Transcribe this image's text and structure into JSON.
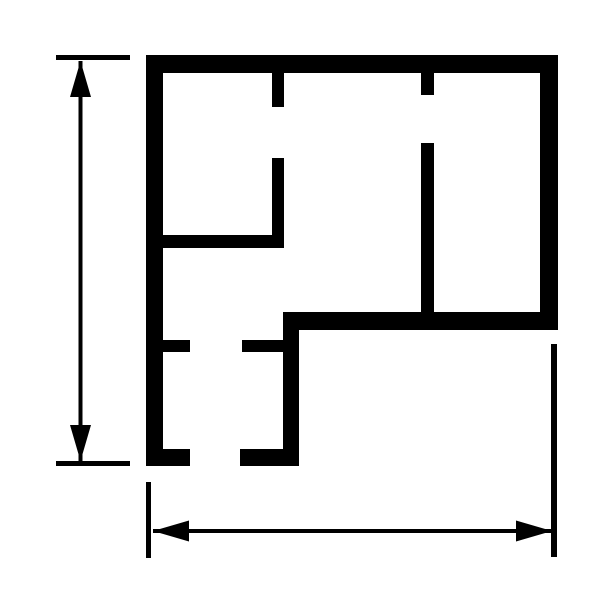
{
  "canvas": {
    "width": 612,
    "height": 612,
    "background_color": "#ffffff",
    "ink_color": "#000000"
  },
  "floorplan": {
    "description": "floor-plan-outline-with-dimension-lines",
    "walls": [
      {
        "name": "outer-top-wall",
        "x": 146,
        "y": 55,
        "w": 412,
        "h": 18
      },
      {
        "name": "outer-left-wall",
        "x": 146,
        "y": 55,
        "w": 17,
        "h": 411
      },
      {
        "name": "outer-right-wall",
        "x": 540,
        "y": 55,
        "w": 18,
        "h": 275
      },
      {
        "name": "outer-bottom-right-wall",
        "x": 283,
        "y": 312,
        "w": 275,
        "h": 18
      },
      {
        "name": "outer-step-wall",
        "x": 283,
        "y": 312,
        "w": 16,
        "h": 154
      },
      {
        "name": "outer-bottom-left-wall-west",
        "x": 146,
        "y": 449,
        "w": 44,
        "h": 17
      },
      {
        "name": "outer-bottom-left-wall-east",
        "x": 240,
        "y": 449,
        "w": 59,
        "h": 17
      },
      {
        "name": "interior-wall-v1-upper-stub",
        "x": 272,
        "y": 73,
        "w": 12,
        "h": 34
      },
      {
        "name": "interior-wall-v1-lower",
        "x": 272,
        "y": 158,
        "w": 12,
        "h": 90
      },
      {
        "name": "interior-wall-h1",
        "x": 163,
        "y": 235,
        "w": 121,
        "h": 13
      },
      {
        "name": "interior-wall-v2-upper-stub",
        "x": 421,
        "y": 73,
        "w": 13,
        "h": 22
      },
      {
        "name": "interior-wall-v2-lower",
        "x": 421,
        "y": 143,
        "w": 13,
        "h": 169
      },
      {
        "name": "interior-wall-h2-west-stub",
        "x": 163,
        "y": 340,
        "w": 27,
        "h": 12
      },
      {
        "name": "interior-wall-h2-east-stub",
        "x": 242,
        "y": 340,
        "w": 41,
        "h": 12
      }
    ]
  },
  "dimensions": [
    {
      "name": "height-dimension",
      "orientation": "vertical",
      "line": {
        "name": "height-dimension-line",
        "x1": 80.5,
        "y1": 61,
        "x2": 80.5,
        "y2": 461,
        "stroke_width": 4
      },
      "ticks": [
        {
          "name": "height-top-extension-tick",
          "x": 56,
          "y": 55,
          "w": 74,
          "h": 5
        },
        {
          "name": "height-bottom-extension-tick",
          "x": 56,
          "y": 461,
          "w": 74,
          "h": 5
        }
      ],
      "arrowheads": [
        {
          "name": "up-arrowhead",
          "points": "80.5,61 70,97 91,97"
        },
        {
          "name": "down-arrowhead",
          "points": "80.5,461 70,425 91,425"
        }
      ]
    },
    {
      "name": "width-dimension",
      "orientation": "horizontal",
      "line": {
        "name": "width-dimension-line",
        "x1": 153,
        "y1": 531,
        "x2": 552,
        "y2": 531,
        "stroke_width": 4
      },
      "ticks": [
        {
          "name": "width-left-extension-tick",
          "x": 146,
          "y": 482,
          "w": 5,
          "h": 76
        },
        {
          "name": "width-right-extension-tick",
          "x": 551,
          "y": 344,
          "w": 6,
          "h": 213
        }
      ],
      "arrowheads": [
        {
          "name": "left-arrowhead",
          "points": "153,531 189,520.5 189,541.5"
        },
        {
          "name": "right-arrowhead",
          "points": "552,531 516,520.5 516,541.5"
        }
      ]
    }
  ]
}
